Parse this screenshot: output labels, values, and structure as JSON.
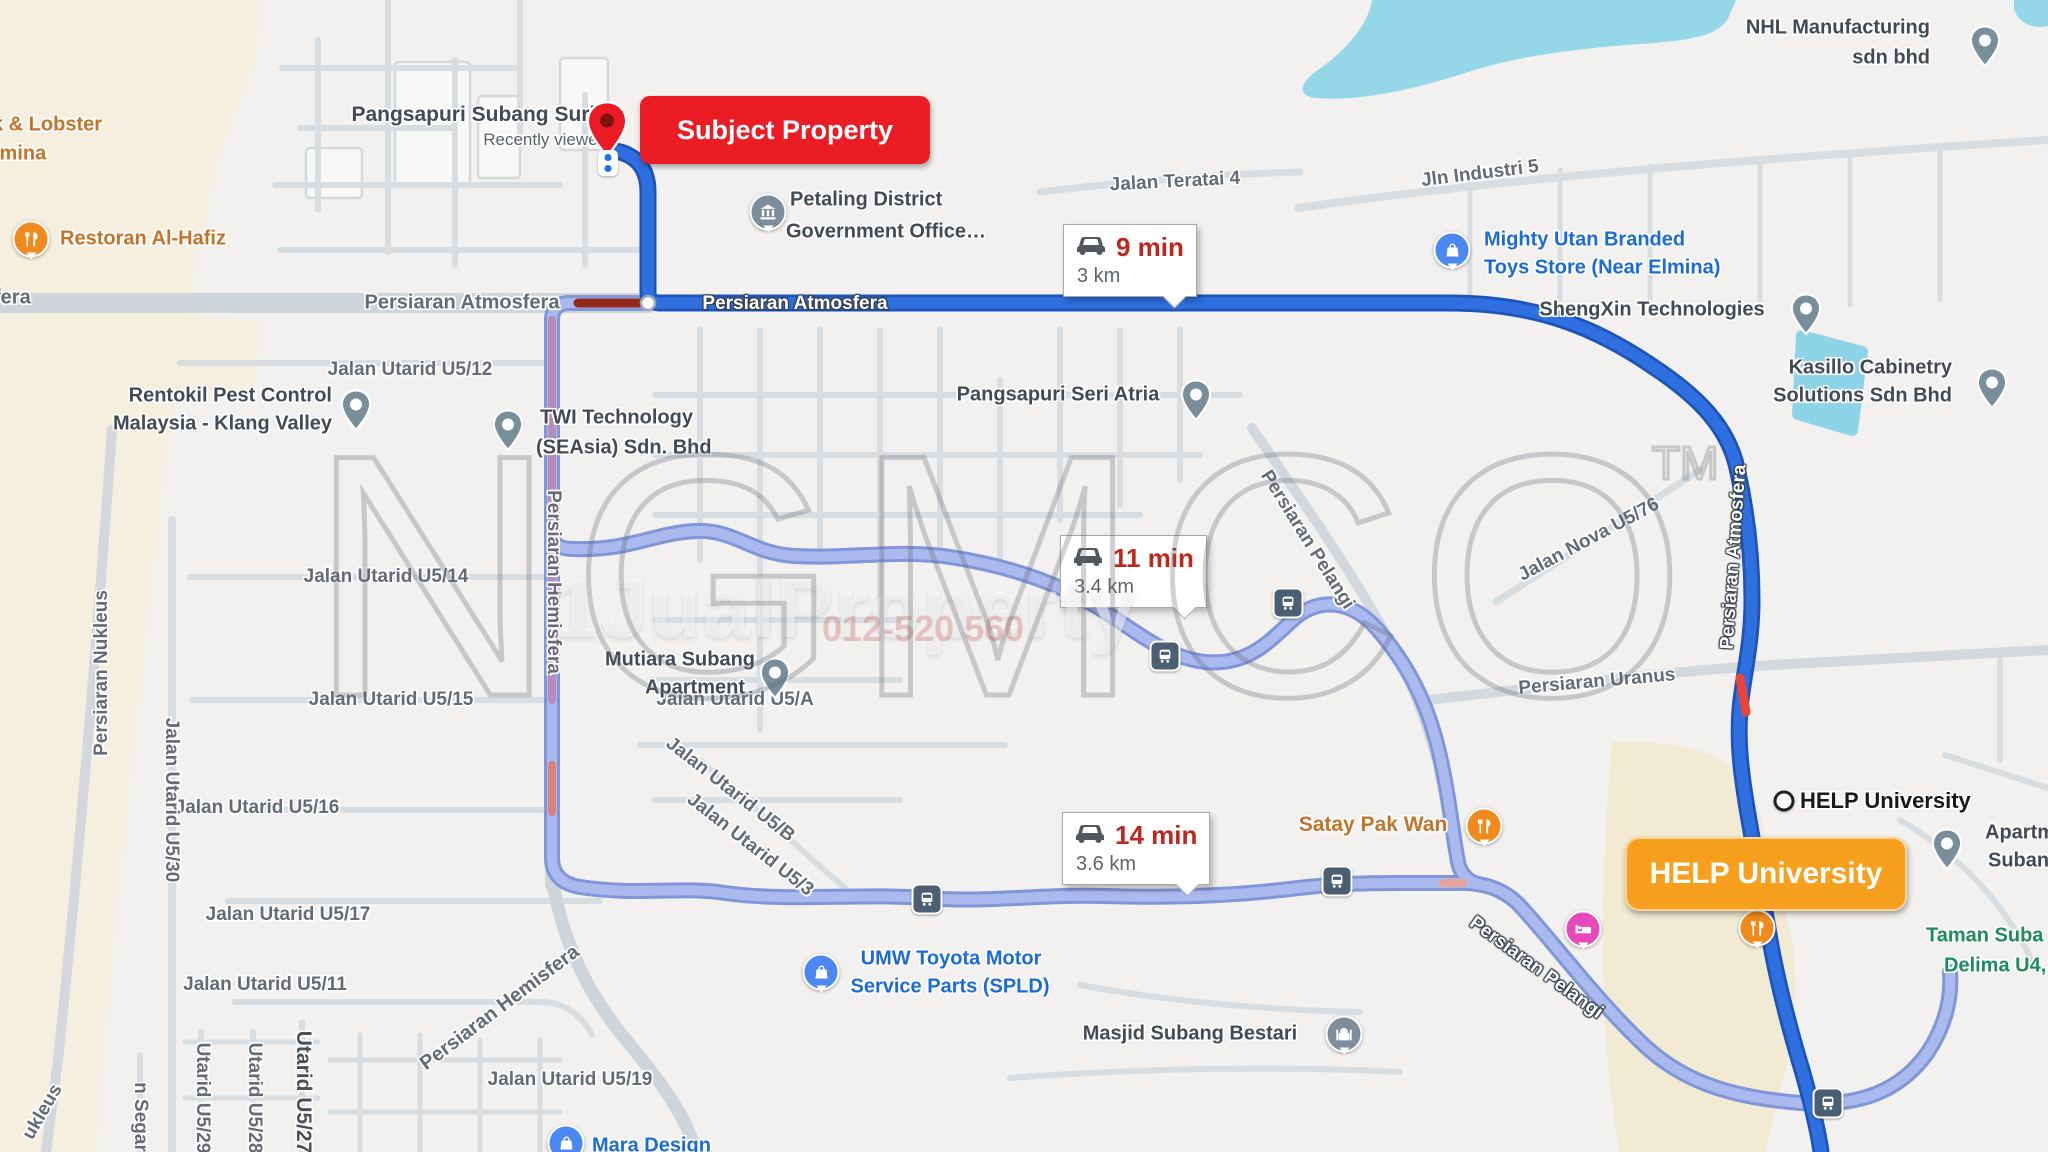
{
  "watermark": {
    "big": "NGMCO",
    "tm": "TM",
    "brand": "1JualProperty",
    "phone": "012-520 560"
  },
  "origin": {
    "badge": "Subject Property",
    "poi": "Pangsapuri Subang Suria",
    "note": "Recently viewed"
  },
  "destination": {
    "badge": "HELP University",
    "poi": "HELP University"
  },
  "routes": [
    {
      "duration": "9 min",
      "distance": "3 km"
    },
    {
      "duration": "11 min",
      "distance": "3.4 km"
    },
    {
      "duration": "14 min",
      "distance": "3.6 km"
    }
  ],
  "colors": {
    "accent_red": "#EC1C24",
    "accent_orange": "#F7A01D",
    "route_blue": "#2F6FE0",
    "route_alt": "#AAB9EE"
  },
  "icons": {
    "origin": "red-map-pin",
    "destination": "circle-marker",
    "poi_generic": "gray-teardrop-pin",
    "transit": "bus-stop",
    "traffic": "car"
  },
  "roads": {
    "atmosfera_w": "Persiaran Atmosfera",
    "atmosfera_on_route": "Persiaran Atmosfera",
    "atmosfera_right": "Persiaran Atmosfera",
    "fera_cut": "fera",
    "u5_12": "Jalan Utarid U5/12",
    "u5_14": "Jalan Utarid U5/14",
    "u5_15": "Jalan Utarid U5/15",
    "u5_16": "Jalan Utarid U5/16",
    "u5_17": "Jalan Utarid U5/17",
    "u5_11": "Jalan Utarid U5/11",
    "u5_19": "Jalan Utarid U5/19",
    "u5_30": "Jalan Utarid U5/30",
    "u5_29": "Utarid U5/29",
    "u5_28": "Utarid U5/28",
    "u5_27": "Utarid U5/27",
    "nukleus": "Persiaran Nukleus",
    "nukleus_cut": "ukleus",
    "segar_cut": "n Segar",
    "hemisfera_on_route": "Persiaran Hemisfera",
    "hemisfera_bottom": "Persiaran Hemisfera",
    "u5_a": "Jalan Utarid U5/A",
    "u5_b": "Jalan Utarid U5/B",
    "u5_3": "Jalan Utarid U5/3",
    "teratai_4": "Jalan Teratai 4",
    "industri_5": "Jln Industri 5",
    "pelangi_upper": "Persiaran Pelangi",
    "pelangi_lower": "Persiaran Pelangi",
    "uranus": "Persiaran Uranus",
    "nova_u5_76": "Jalan Nova U5/76"
  },
  "pois": {
    "pangsapuri_subang_suria": "Pangsapuri Subang Suria",
    "recently_viewed": "Recently viewed",
    "petaling_1": "Petaling District",
    "petaling_2": "Government Office…",
    "restoran_al_hafiz": "Restoran Al-Hafiz",
    "lobster_cut": "k & Lobster",
    "elmina_cut": "lmina",
    "rentokil_1": "Rentokil Pest Control",
    "rentokil_2": "Malaysia - Klang Valley",
    "twi_1": "TWI Technology",
    "twi_2": "(SEAsia) Sdn. Bhd",
    "seri_atria": "Pangsapuri Seri Atria",
    "mutiara_1": "Mutiara Subang",
    "mutiara_2": "Apartment",
    "mighty_1": "Mighty Utan Branded",
    "mighty_2": "Toys Store (Near Elmina)",
    "shengxin": "ShengXin Technologies",
    "kasillo_1": "Kasillo Cabinetry",
    "kasillo_2": "Solutions Sdn Bhd",
    "nhl_1": "NHL Manufacturing",
    "nhl_2": "sdn bhd",
    "satay_pak_wan": "Satay Pak Wan",
    "umw_1": "UMW Toyota Motor",
    "umw_2": "Service Parts (SPLD)",
    "masjid": "Masjid Subang Bestari",
    "help_poi": "HELP University",
    "apart_1": "Apartme",
    "apart_2": "Subang",
    "taman_1": "Taman Suba",
    "taman_2": "Delima U4,",
    "mara": "Mara Design"
  }
}
